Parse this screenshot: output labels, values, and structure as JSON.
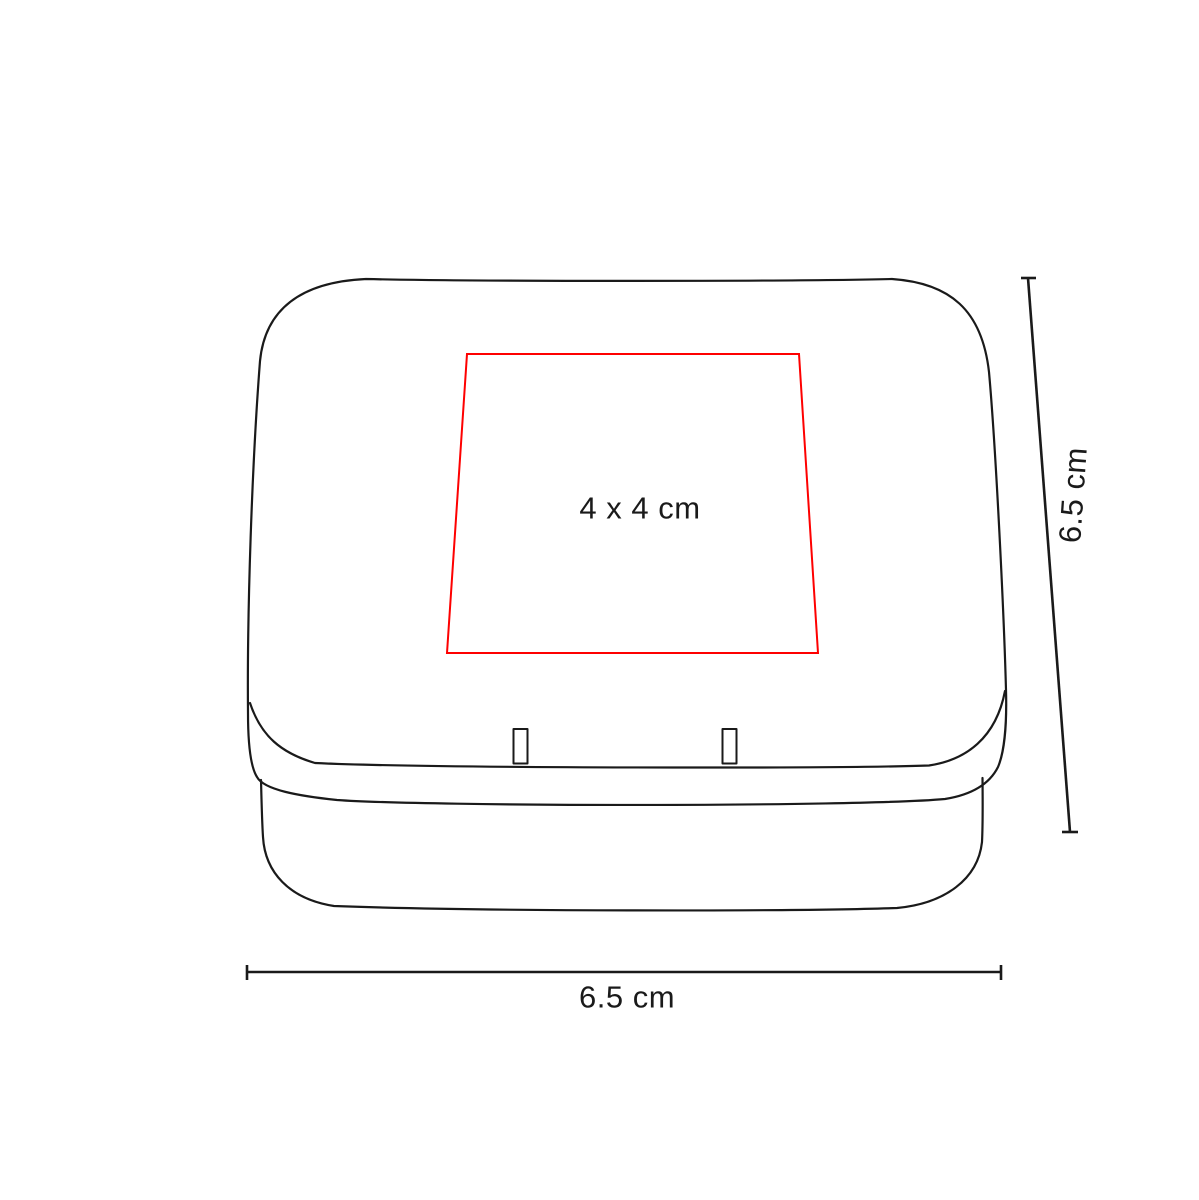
{
  "diagram": {
    "title": "tin-box-dimension-diagram",
    "product": "hinged tin box (perspective line drawing)",
    "print_area": {
      "label": "4 x 4 cm",
      "color": "#fe0000"
    },
    "dimensions": {
      "height": {
        "label": "6.5 cm"
      },
      "width": {
        "label": "6.5 cm"
      }
    },
    "line_color": "#1a1a1a",
    "background_color": "#ffffff"
  }
}
